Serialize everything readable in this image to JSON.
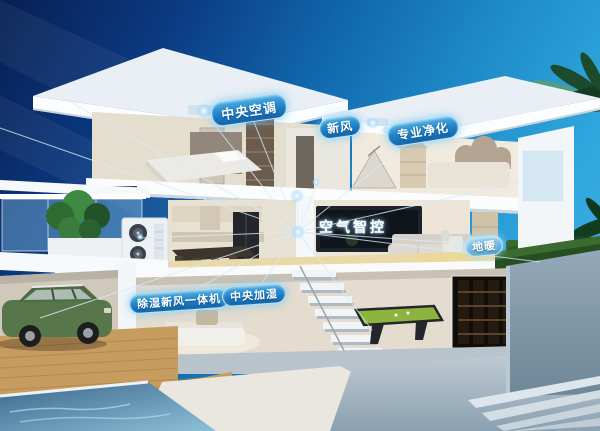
{
  "labels": {
    "central_ac": "中央空调",
    "fresh_air": "新风",
    "purification": "专业净化",
    "air_smart_control": "空气智控",
    "floor_heating": "地暖",
    "dehumid_fresh_air_unit": "除湿新风一体机",
    "central_humidification": "中央加湿"
  },
  "icons": {
    "network_hub": "radiating-lines-hub",
    "ceiling_glow_dots": "device-glow-dot"
  },
  "colors": {
    "sky_dark": "#081f52",
    "sky_light": "#49b4e4",
    "badge_blue_top": "#4fb0e2",
    "badge_blue_bottom": "#1263a9",
    "network_line": "#d6ecfa",
    "billiard_green": "#8cb43f",
    "car_green": "#57764a",
    "pool_water": "#8fc0d8",
    "roof_white": "#fbfdfe",
    "floor_heating_glow": "#ead896"
  }
}
